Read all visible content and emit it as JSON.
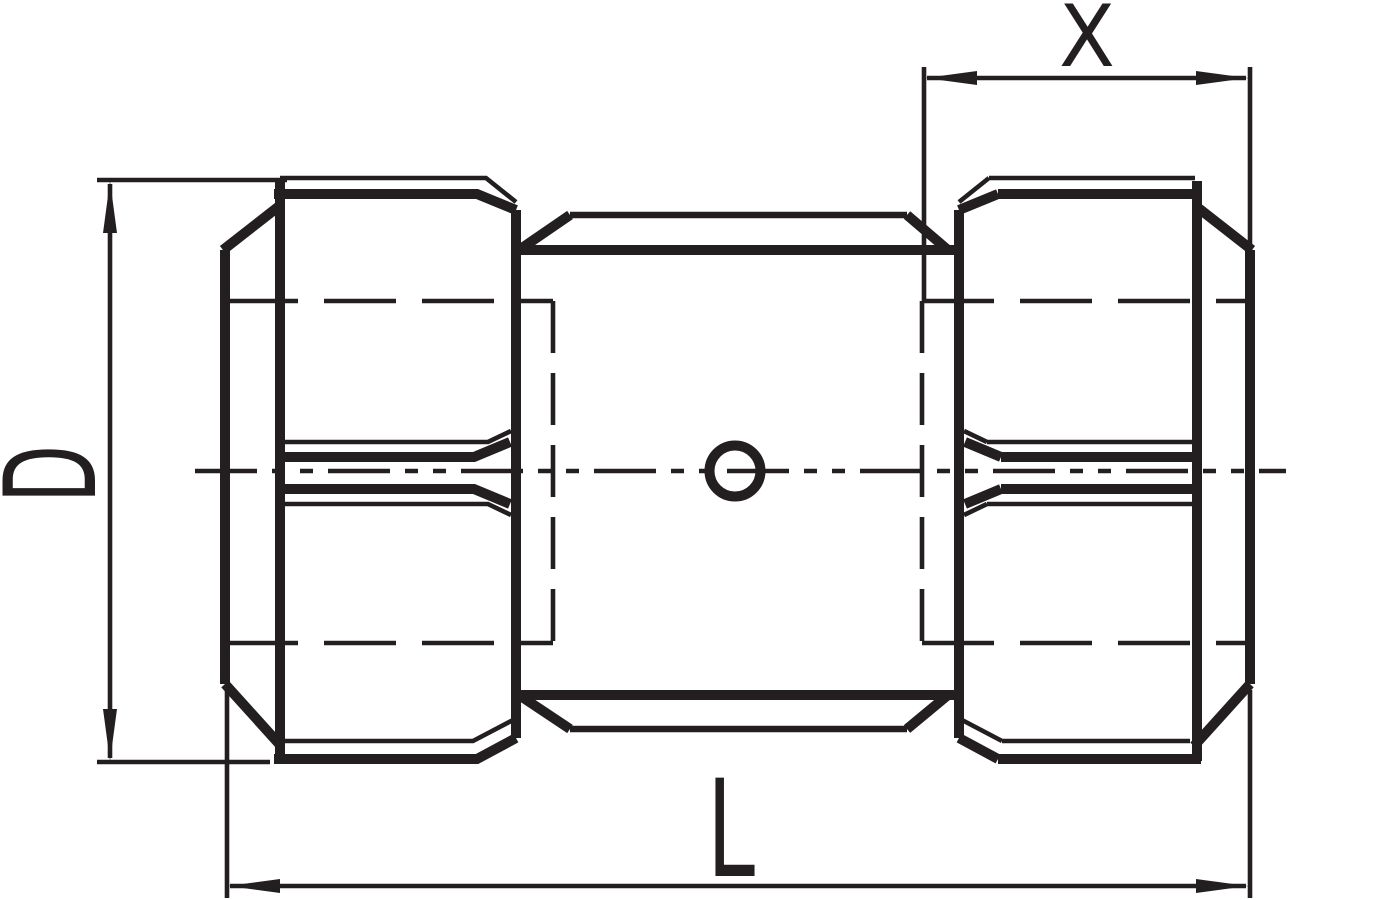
{
  "canvas": {
    "width": 1400,
    "height": 900,
    "background": "#ffffff",
    "line_color": "#231f20"
  },
  "drawing": {
    "type": "engineering-dimension-drawing",
    "subject": "pipe coupling with two hex nuts, side view"
  },
  "labels": {
    "diameter": "D",
    "overall_length": "L",
    "nut_width": "X"
  }
}
